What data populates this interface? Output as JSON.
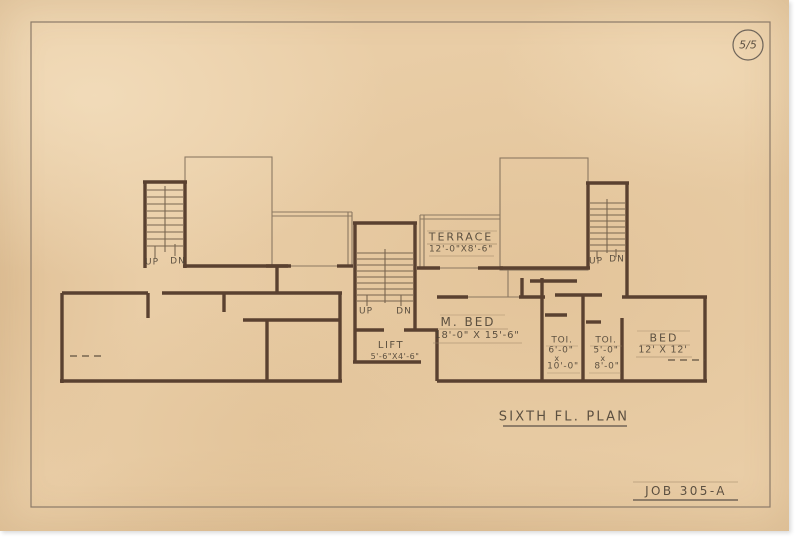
{
  "sheet": {
    "number": "5/5",
    "title": "SIXTH FL. PLAN",
    "job": "JOB 305-A"
  },
  "rooms": {
    "terrace": {
      "name": "TERRACE",
      "dims": "12'-0\"X8'-6\""
    },
    "m_bed": {
      "name": "M. BED",
      "dims": "18'-0\" X 15'-6\""
    },
    "toi_1": {
      "name": "TOI.",
      "d1": "6'-0\"",
      "x": "x",
      "d2": "10'-0\""
    },
    "toi_2": {
      "name": "TOI.",
      "d1": "5'-0\"",
      "x": "x",
      "d2": "8'-0\""
    },
    "bed": {
      "name": "BED",
      "dims": "12' X 12'"
    },
    "lift": {
      "name": "LIFT",
      "dims": "5'-6\"X4'-6\""
    }
  },
  "stairs": {
    "left": {
      "up": "UP",
      "dn": "DN"
    },
    "center": {
      "up": "UP",
      "dn": "DN"
    },
    "right": {
      "up": "UP",
      "dn": "DN"
    }
  },
  "colors": {
    "paper": "#e9cda6",
    "wall": "#5a4130",
    "pencil": "#7c6b57",
    "ink": "#4a4034"
  }
}
